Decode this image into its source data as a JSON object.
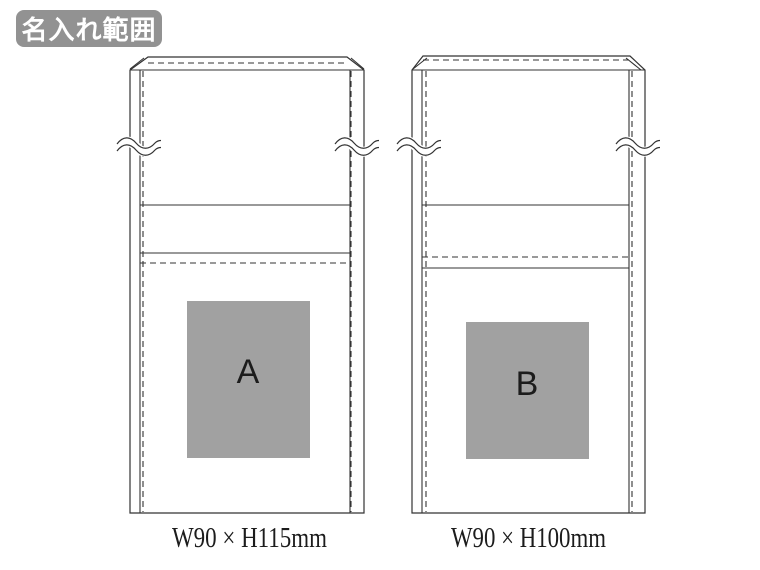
{
  "badge": {
    "label": "名入れ範囲"
  },
  "colors": {
    "badge_bg": "#929292",
    "badge_text": "#ffffff",
    "line": "#333333",
    "print_area_fill": "#a1a1a1",
    "label_ink": "#1c1c1c"
  },
  "diagram": {
    "bags": [
      {
        "area_label": "A",
        "size_label": "W90 × H115mm"
      },
      {
        "area_label": "B",
        "size_label": "W90 × H100mm"
      }
    ]
  }
}
